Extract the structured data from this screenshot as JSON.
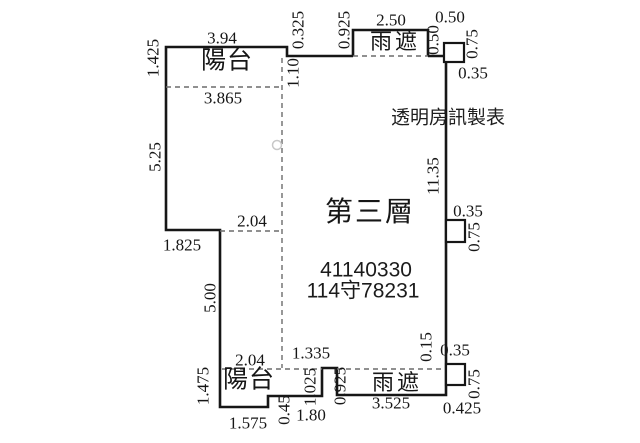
{
  "page": {
    "background": "#ffffff",
    "line_color": "#161616",
    "dash_color": "#6b6b6b",
    "marker_color": "#c8c8c8"
  },
  "plan": {
    "floor_label": "第三層",
    "maker_label": "透明房訊製表",
    "id_number_1": "41140330",
    "id_number_2": "114守78231",
    "balcony_top_label": "陽台",
    "balcony_bottom_label": "陽台",
    "canopy_top_label": "雨遮",
    "canopy_bottom_label": "雨遮",
    "geometry": {
      "solid_paths": [
        "M 353 56 L 287 56 L 287 47 L 166 47 L 166 230 L 220 230 L 220 407 L 268 407 L 268 396 L 322 396 L 322 368 L 337 368 L 337 395 L 446 395 L 446 56 L 428 56",
        "M 353 56 L 353 30 L 428 30 L 428 56"
      ],
      "dashed_paths": [
        "M 353 56 L 428 56",
        "M 166 87 L 282 87",
        "M 282 58 L 282 368",
        "M 220 231 L 282 231",
        "M 222 369 L 322 369",
        "M 337 369 L 444 369"
      ],
      "squares": [
        {
          "x": 444,
          "y": 43,
          "w": 20,
          "h": 19
        },
        {
          "x": 446,
          "y": 220,
          "w": 19,
          "h": 22
        },
        {
          "x": 446,
          "y": 364,
          "w": 19,
          "h": 21
        }
      ],
      "circle": {
        "cx": 277,
        "cy": 145,
        "r": 4.5
      }
    },
    "dimension_labels": [
      {
        "text": "3.94",
        "x": 222,
        "y": 38,
        "rot": "h"
      },
      {
        "text": "1.425",
        "x": 153,
        "y": 58,
        "rot": "v"
      },
      {
        "text": "0.325",
        "x": 298,
        "y": 30,
        "rot": "v"
      },
      {
        "text": "0.925",
        "x": 344,
        "y": 30,
        "rot": "v"
      },
      {
        "text": "2.50",
        "x": 391,
        "y": 20,
        "rot": "h"
      },
      {
        "text": "0.50",
        "x": 450,
        "y": 17,
        "rot": "h"
      },
      {
        "text": "0.50",
        "x": 433,
        "y": 40,
        "rot": "v"
      },
      {
        "text": "0.75",
        "x": 472,
        "y": 44,
        "rot": "v"
      },
      {
        "text": "0.35",
        "x": 473,
        "y": 73,
        "rot": "h"
      },
      {
        "text": "1.10",
        "x": 293,
        "y": 73,
        "rot": "v"
      },
      {
        "text": "3.865",
        "x": 223,
        "y": 98,
        "rot": "h"
      },
      {
        "text": "5.25",
        "x": 155,
        "y": 157,
        "rot": "v"
      },
      {
        "text": "11.35",
        "x": 433,
        "y": 176,
        "rot": "v"
      },
      {
        "text": "0.35",
        "x": 468,
        "y": 211,
        "rot": "h"
      },
      {
        "text": "2.04",
        "x": 252,
        "y": 221,
        "rot": "h"
      },
      {
        "text": "0.75",
        "x": 474,
        "y": 237,
        "rot": "v"
      },
      {
        "text": "1.825",
        "x": 182,
        "y": 245,
        "rot": "h"
      },
      {
        "text": "5.00",
        "x": 210,
        "y": 298,
        "rot": "v"
      },
      {
        "text": "0.15",
        "x": 426,
        "y": 347,
        "rot": "v"
      },
      {
        "text": "0.35",
        "x": 455,
        "y": 350,
        "rot": "h"
      },
      {
        "text": "1.335",
        "x": 311,
        "y": 353,
        "rot": "h"
      },
      {
        "text": "2.04",
        "x": 250,
        "y": 360,
        "rot": "h"
      },
      {
        "text": "0.75",
        "x": 474,
        "y": 384,
        "rot": "v"
      },
      {
        "text": "1.475",
        "x": 203,
        "y": 386,
        "rot": "v"
      },
      {
        "text": "1.025",
        "x": 310,
        "y": 387,
        "rot": "v"
      },
      {
        "text": "0.925",
        "x": 340,
        "y": 386,
        "rot": "v"
      },
      {
        "text": "3.525",
        "x": 391,
        "y": 403,
        "rot": "h"
      },
      {
        "text": "0.425",
        "x": 462,
        "y": 408,
        "rot": "h"
      },
      {
        "text": "0.45",
        "x": 284,
        "y": 410,
        "rot": "v"
      },
      {
        "text": "1.80",
        "x": 311,
        "y": 415,
        "rot": "h"
      },
      {
        "text": "1.575",
        "x": 248,
        "y": 423,
        "rot": "h"
      }
    ]
  }
}
